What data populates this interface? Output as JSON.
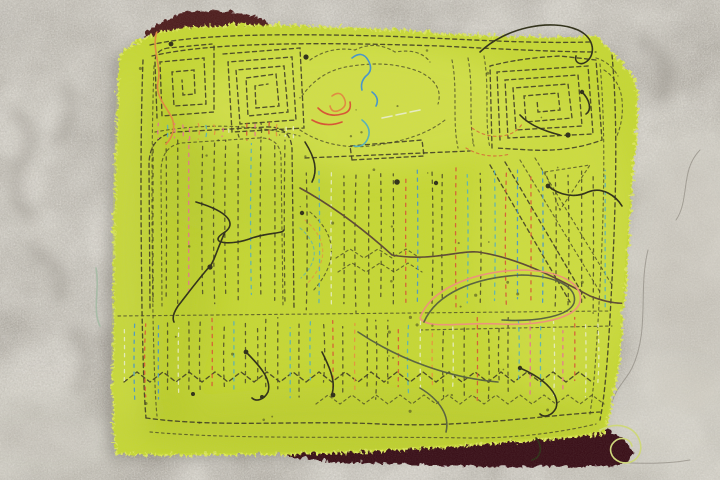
{
  "scene": {
    "description": "Bright chartreuse mola textile panel, hand-basted with dashed running stitches forming greek-key spirals, arches and vertical quilting channels, with loose threads and knots, resting over a maroon under-cloth on a weathered gray concrete floor",
    "subject": "mola textile work in progress",
    "surface": "concrete floor",
    "motifs": [
      "greek-key-spiral-left",
      "greek-key-spiral-center",
      "square-spiral-right",
      "arch-window",
      "vertical-stitch-channels",
      "zigzag-rows",
      "thread-tangle"
    ]
  },
  "colors": {
    "concrete_base": "#a49f96",
    "concrete_light": "#d8d4c9",
    "concrete_dark": "#7b766d",
    "concrete_shadow": "#55514a",
    "fabric": "#c6d832",
    "fabric_light": "#dde85e",
    "fabric_dark": "#a9bc22",
    "maroon": "#4e1a1d",
    "maroon_dark": "#380b12",
    "stitch_dark": "#3c3a1f",
    "stitch_red": "#d85230",
    "stitch_pink": "#ea6f93",
    "stitch_orange": "#e8903b",
    "stitch_teal": "#54b0ba",
    "stitch_blue": "#4493cc",
    "stitch_pale": "#e9eec4",
    "thread_dark": "#2c2c14",
    "thread_brown": "#5a4630",
    "thread_orange": "#e2893c",
    "thread_salmon": "#ef9277",
    "thread_olive": "#56603a",
    "thread_pale": "#cfd978",
    "thread_teal": "#9fb9a0"
  },
  "stitch_columns": {
    "seed": 1337,
    "dash": "3.2 4.8",
    "width": 1.3,
    "regions": [
      {
        "name": "arch-interior",
        "x0": 154,
        "x1": 290,
        "spacing": 12,
        "y0": 142,
        "y1": 300,
        "jitter": 8,
        "colorful": false
      },
      {
        "name": "mid-field",
        "x0": 306,
        "x1": 610,
        "spacing": 12.5,
        "y0": 172,
        "y1": 306,
        "jitter": 10,
        "colorful": false
      },
      {
        "name": "lower-band",
        "x0": 124,
        "x1": 606,
        "spacing": 11,
        "y0": 324,
        "y1": 390,
        "jitter": 14,
        "colorful": false
      },
      {
        "name": "top-fringe",
        "x0": 158,
        "x1": 298,
        "spacing": 8,
        "y0": 124,
        "y1": 138,
        "jitter": 3,
        "colorful": true
      }
    ],
    "weights": [
      [
        "stitch_dark",
        0.56
      ],
      [
        "stitch_pink",
        0.08
      ],
      [
        "stitch_red",
        0.07
      ],
      [
        "stitch_orange",
        0.08
      ],
      [
        "stitch_teal",
        0.08
      ],
      [
        "stitch_blue",
        0.05
      ],
      [
        "stitch_pale",
        0.08
      ]
    ],
    "colorful_weights": [
      [
        "stitch_pink",
        0.22
      ],
      [
        "stitch_red",
        0.18
      ],
      [
        "stitch_orange",
        0.2
      ],
      [
        "stitch_teal",
        0.18
      ],
      [
        "stitch_pale",
        0.12
      ],
      [
        "stitch_dark",
        0.1
      ]
    ]
  },
  "speckles": {
    "seed": 7,
    "count": 46,
    "x0": 135,
    "x1": 598,
    "y0": 45,
    "y1": 425
  }
}
